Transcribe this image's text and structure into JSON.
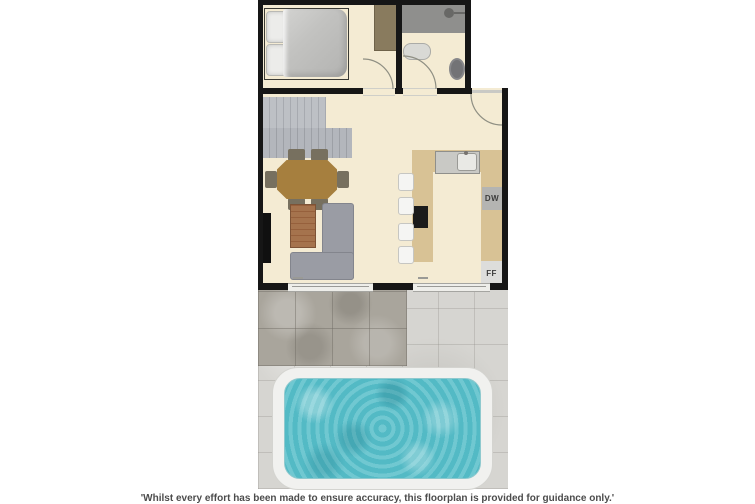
{
  "floorplan": {
    "labels": {
      "dishwasher": "DW",
      "fridge_freezer": "FF"
    },
    "disclaimer": "'Whilst every effort has been made to ensure accuracy, this floorplan is provided for guidance only.'",
    "palette": {
      "wall": "#161616",
      "floor": "#f4ebd3",
      "counter": "#d8c295",
      "stairs_a": "#bdc0c5",
      "stairs_b": "#b3b6bc",
      "sofa": "#9a9ca4",
      "dining_table": "#a67f3e",
      "chair": "#77705f",
      "coffee_table": "#a5734d",
      "wardrobe": "#897b5e",
      "shower_tray": "#8f8f8d",
      "fixture_gray": "#737376",
      "tile_dark": "#a9a59c",
      "tile_light": "#d6d5d1",
      "pool_water": "#58bfca",
      "pool_surround": "#f1f1ef",
      "appliance_dw": "#b4b4b2",
      "appliance_ff": "#dddddb",
      "hob": "#1b1b1b",
      "duvet": "#c2c2c0",
      "pillow": "#ececea",
      "stool": "#f5f5f3",
      "disclaimer_text": "#4c4c4c"
    }
  }
}
